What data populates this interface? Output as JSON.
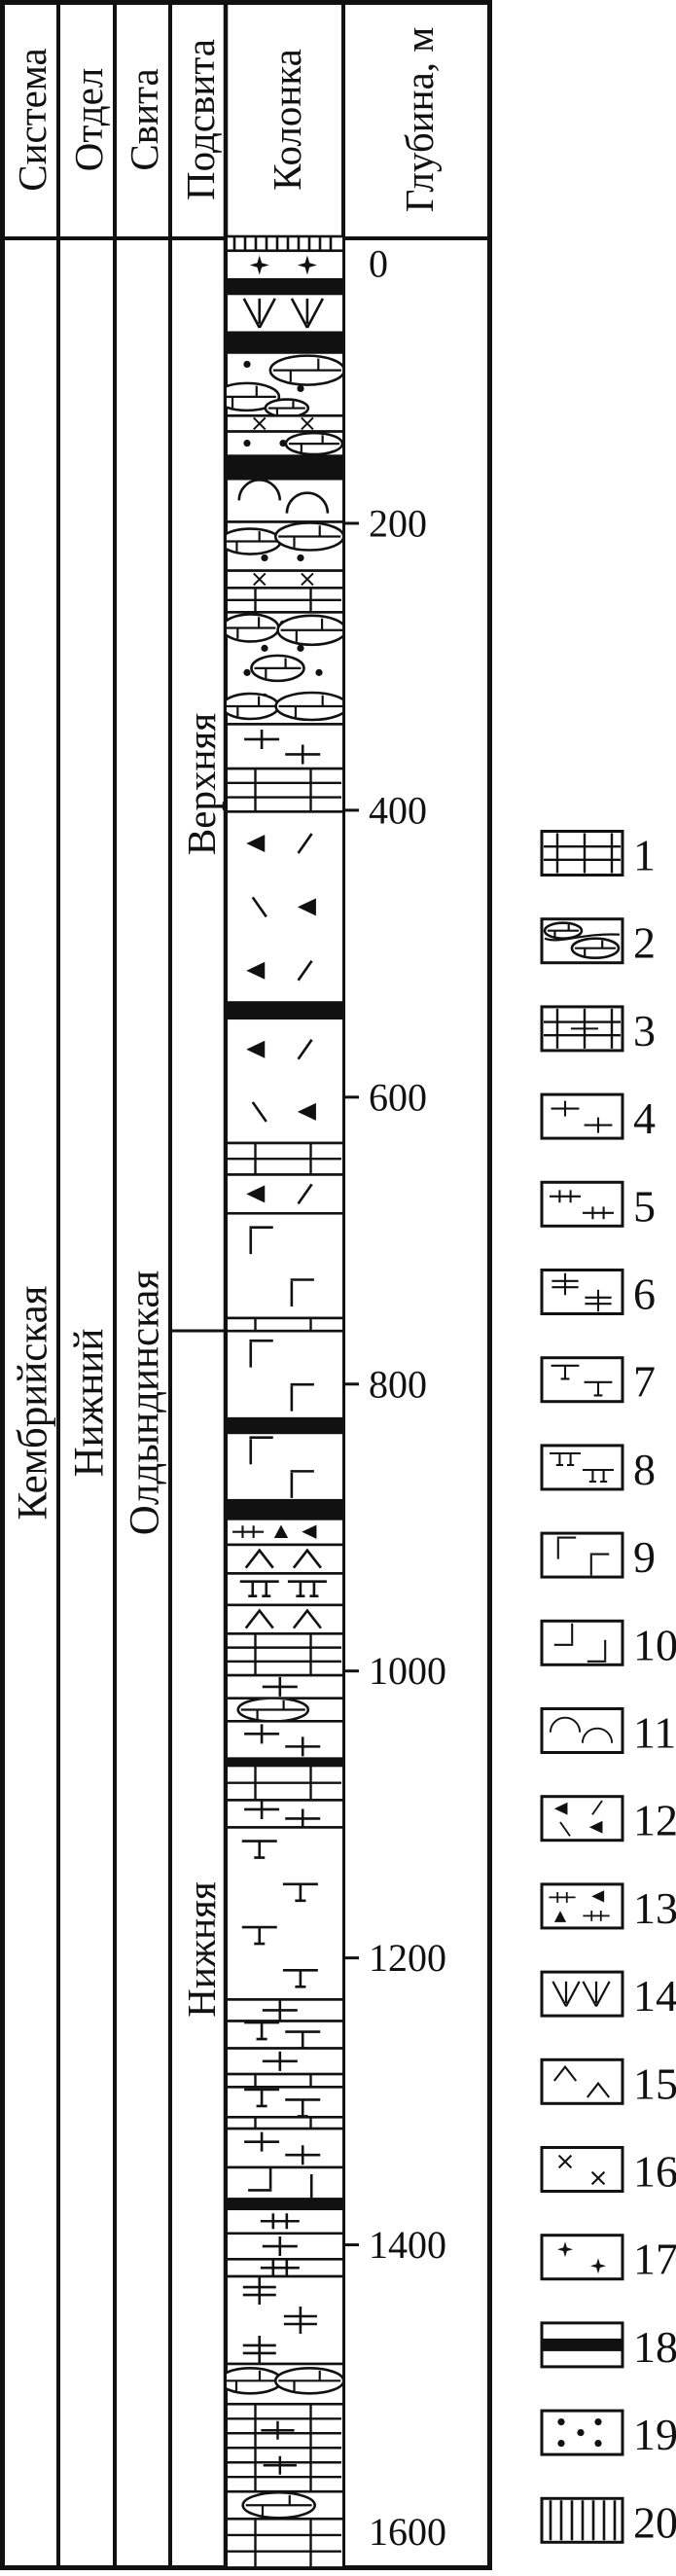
{
  "figure": {
    "header": [
      "Система",
      "Отдел",
      "Свита",
      "Подсвита",
      "Колонка",
      "Глубина, м"
    ]
  },
  "stratigraphy": {
    "system": "Кембрийская",
    "series": "Нижний",
    "formation": "Олдындинская",
    "subformation_upper": "Верхняя",
    "subformation_lower": "Нижняя",
    "subformation_boundary_m": 763
  },
  "depth_axis": {
    "label": "Глубина, м",
    "ticks": [
      {
        "label": "0",
        "m": 0,
        "line": false
      },
      {
        "label": "200",
        "m": 200,
        "line": true
      },
      {
        "label": "400",
        "m": 400,
        "line": true
      },
      {
        "label": "600",
        "m": 600,
        "line": true
      },
      {
        "label": "800",
        "m": 800,
        "line": true
      },
      {
        "label": "1000",
        "m": 1000,
        "line": true
      },
      {
        "label": "1200",
        "m": 1200,
        "line": true
      },
      {
        "label": "1400",
        "m": 1400,
        "line": true
      },
      {
        "label": "1600",
        "m": 1600,
        "line": false
      }
    ]
  },
  "chart_data": {
    "type": "stratigraphic-column",
    "depth_unit": "m",
    "depth_range": [
      0,
      1625
    ],
    "ink_color": "#111111",
    "paper_color": "#ffffff",
    "bands": [
      {
        "top": 0,
        "base": 10,
        "pattern": "vhatch"
      },
      {
        "top": 10,
        "base": 30,
        "pattern": "star"
      },
      {
        "top": 30,
        "base": 40,
        "pattern": "black"
      },
      {
        "top": 40,
        "base": 67,
        "pattern": "varrow"
      },
      {
        "top": 67,
        "base": 81,
        "pattern": "black"
      },
      {
        "top": 81,
        "base": 125,
        "pattern": "dots-lens",
        "lenses": [
          [
            0.7,
            0.28,
            38,
            15
          ],
          [
            0.17,
            0.7,
            33,
            14
          ],
          [
            0.52,
            0.88,
            22,
            9
          ]
        ]
      },
      {
        "top": 125,
        "base": 136,
        "pattern": "xcross"
      },
      {
        "top": 136,
        "base": 153,
        "pattern": "dots-lens",
        "lenses": [
          [
            0.76,
            0.5,
            29,
            11
          ]
        ]
      },
      {
        "top": 153,
        "base": 169,
        "pattern": "black"
      },
      {
        "top": 169,
        "base": 199,
        "pattern": "arc"
      },
      {
        "top": 199,
        "base": 233,
        "pattern": "dots-lens",
        "lenses": [
          [
            0.2,
            0.4,
            31,
            13
          ],
          [
            0.72,
            0.3,
            35,
            14
          ]
        ]
      },
      {
        "top": 233,
        "base": 245,
        "pattern": "xcross"
      },
      {
        "top": 245,
        "base": 262,
        "pattern": "brick"
      },
      {
        "top": 262,
        "base": 340,
        "pattern": "dots-lens",
        "lenses": [
          [
            0.2,
            0.14,
            29,
            14
          ],
          [
            0.74,
            0.16,
            35,
            15
          ],
          [
            0.44,
            0.5,
            27,
            13
          ],
          [
            0.2,
            0.84,
            29,
            13
          ],
          [
            0.74,
            0.84,
            37,
            14
          ]
        ]
      },
      {
        "top": 340,
        "base": 371,
        "pattern": "plus"
      },
      {
        "top": 371,
        "base": 401,
        "pattern": "brick"
      },
      {
        "top": 401,
        "base": 534,
        "pattern": "trislash"
      },
      {
        "top": 534,
        "base": 545,
        "pattern": "black"
      },
      {
        "top": 545,
        "base": 632,
        "pattern": "trislash"
      },
      {
        "top": 632,
        "base": 654,
        "pattern": "brick"
      },
      {
        "top": 654,
        "base": 681,
        "pattern": "trislash"
      },
      {
        "top": 681,
        "base": 754,
        "pattern": "gamma"
      },
      {
        "top": 754,
        "base": 763,
        "pattern": "brick"
      },
      {
        "top": 763,
        "base": 824,
        "pattern": "gamma"
      },
      {
        "top": 824,
        "base": 834,
        "pattern": "black"
      },
      {
        "top": 834,
        "base": 881,
        "pattern": "gamma"
      },
      {
        "top": 881,
        "base": 894,
        "pattern": "black"
      },
      {
        "top": 894,
        "base": 912,
        "pattern": "ticktri"
      },
      {
        "top": 912,
        "base": 932,
        "pattern": "caret"
      },
      {
        "top": 932,
        "base": 954,
        "pattern": "dtee"
      },
      {
        "top": 954,
        "base": 974,
        "pattern": "caret"
      },
      {
        "top": 974,
        "base": 1003,
        "pattern": "brick"
      },
      {
        "top": 1003,
        "base": 1019,
        "pattern": "plus"
      },
      {
        "top": 1019,
        "base": 1035,
        "pattern": "lens",
        "lenses": [
          [
            0.4,
            0.5,
            36,
            12
          ]
        ]
      },
      {
        "top": 1035,
        "base": 1061,
        "pattern": "plus"
      },
      {
        "top": 1061,
        "base": 1066,
        "pattern": "black"
      },
      {
        "top": 1066,
        "base": 1090,
        "pattern": "brick"
      },
      {
        "top": 1090,
        "base": 1109,
        "pattern": "plus"
      },
      {
        "top": 1109,
        "base": 1229,
        "pattern": "tee"
      },
      {
        "top": 1229,
        "base": 1244,
        "pattern": "plus"
      },
      {
        "top": 1244,
        "base": 1263,
        "pattern": "tee"
      },
      {
        "top": 1263,
        "base": 1281,
        "pattern": "plus"
      },
      {
        "top": 1281,
        "base": 1290,
        "pattern": "brick"
      },
      {
        "top": 1290,
        "base": 1311,
        "pattern": "tee"
      },
      {
        "top": 1311,
        "base": 1319,
        "pattern": "brick"
      },
      {
        "top": 1319,
        "base": 1346,
        "pattern": "plus"
      },
      {
        "top": 1346,
        "base": 1368,
        "pattern": "cornerl"
      },
      {
        "top": 1368,
        "base": 1375,
        "pattern": "black"
      },
      {
        "top": 1375,
        "base": 1392,
        "pattern": "dtick"
      },
      {
        "top": 1392,
        "base": 1410,
        "pattern": "plus"
      },
      {
        "top": 1410,
        "base": 1422,
        "pattern": "dtick"
      },
      {
        "top": 1422,
        "base": 1483,
        "pattern": "dbar"
      },
      {
        "top": 1483,
        "base": 1511,
        "pattern": "lens",
        "lenses": [
          [
            0.2,
            0.42,
            32,
            13
          ],
          [
            0.72,
            0.42,
            35,
            13
          ]
        ]
      },
      {
        "top": 1511,
        "base": 1572,
        "pattern": "brick-plus"
      },
      {
        "top": 1572,
        "base": 1591,
        "pattern": "lens",
        "lenses": [
          [
            0.45,
            0.5,
            37,
            13
          ]
        ]
      },
      {
        "top": 1591,
        "base": 1625,
        "pattern": "brick"
      }
    ],
    "legend": [
      {
        "number": "1",
        "pattern": "brick"
      },
      {
        "number": "2",
        "pattern": "lens"
      },
      {
        "number": "3",
        "pattern": "brick-plus"
      },
      {
        "number": "4",
        "pattern": "plus"
      },
      {
        "number": "5",
        "pattern": "dtick"
      },
      {
        "number": "6",
        "pattern": "dbar"
      },
      {
        "number": "7",
        "pattern": "tee"
      },
      {
        "number": "8",
        "pattern": "dtee"
      },
      {
        "number": "9",
        "pattern": "gamma"
      },
      {
        "number": "10",
        "pattern": "cornerl"
      },
      {
        "number": "11",
        "pattern": "arc"
      },
      {
        "number": "12",
        "pattern": "trislash"
      },
      {
        "number": "13",
        "pattern": "ticktri"
      },
      {
        "number": "14",
        "pattern": "varrow"
      },
      {
        "number": "15",
        "pattern": "caret"
      },
      {
        "number": "16",
        "pattern": "xcross"
      },
      {
        "number": "17",
        "pattern": "star"
      },
      {
        "number": "18",
        "pattern": "black"
      },
      {
        "number": "19",
        "pattern": "dots"
      },
      {
        "number": "20",
        "pattern": "vhatch"
      }
    ]
  }
}
